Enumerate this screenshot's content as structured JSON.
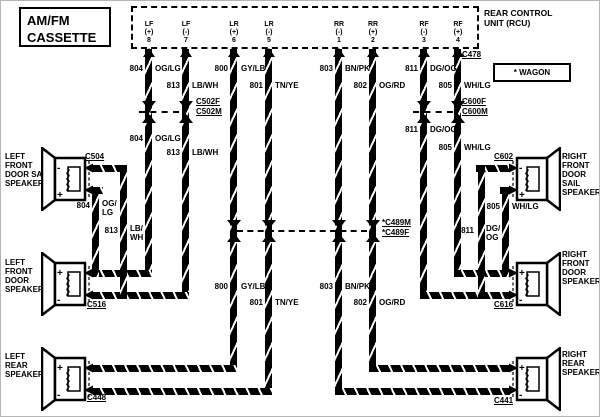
{
  "title": {
    "line1": "AM/FM",
    "line2": "CASSETTE"
  },
  "rcu": {
    "name_line1": "REAR CONTROL",
    "name_line2": "UNIT (RCU)",
    "pins": [
      {
        "ch": "LF",
        "pol": "(+)",
        "num": "8"
      },
      {
        "ch": "LF",
        "pol": "(-)",
        "num": "7"
      },
      {
        "ch": "LR",
        "pol": "(+)",
        "num": "6"
      },
      {
        "ch": "LR",
        "pol": "(-)",
        "num": "5"
      },
      {
        "ch": "RR",
        "pol": "(-)",
        "num": "1"
      },
      {
        "ch": "RR",
        "pol": "(+)",
        "num": "2"
      },
      {
        "ch": "RF",
        "pol": "(-)",
        "num": "3"
      },
      {
        "ch": "RF",
        "pol": "(+)",
        "num": "4"
      }
    ]
  },
  "note": "* WAGON",
  "circuits": {
    "c804": {
      "num": "804",
      "color": "OG/LG",
      "l1": "OG/",
      "l2": "LG"
    },
    "c813": {
      "num": "813",
      "color": "LB/WH",
      "l1": "LB/",
      "l2": "WH"
    },
    "c800": {
      "num": "800",
      "color": "GY/LB"
    },
    "c801": {
      "num": "801",
      "color": "TN/YE"
    },
    "c803": {
      "num": "803",
      "color": "BN/PK"
    },
    "c802": {
      "num": "802",
      "color": "OG/RD"
    },
    "c811": {
      "num": "811",
      "color": "DG/OG",
      "l1": "DG/",
      "l2": "OG"
    },
    "c805": {
      "num": "805",
      "color": "WH/LG"
    }
  },
  "connectors": {
    "c478": "C478",
    "c502f": "C502F",
    "c502m": "C502M",
    "c600f": "C600F",
    "c600m": "C600M",
    "c489m": "*C489M",
    "c489f": "*C489F",
    "c504": "C504",
    "c516": "C516",
    "c448": "C448",
    "c602": "C602",
    "c616": "C616",
    "c441": "C441"
  },
  "speakers": {
    "left_sail": {
      "l1": "LEFT",
      "l2": "FRONT",
      "l3": "DOOR SAIL",
      "l4": "SPEAKER",
      "top_mark": "-",
      "bottom_mark": "+"
    },
    "left_door": {
      "l1": "LEFT",
      "l2": "FRONT",
      "l3": "DOOR",
      "l4": "SPEAKER",
      "top_mark": "+",
      "bottom_mark": "-"
    },
    "left_rear": {
      "l1": "LEFT",
      "l2": "REAR",
      "l3": "SPEAKER",
      "l4": "",
      "top_mark": "+",
      "bottom_mark": "-"
    },
    "right_sail": {
      "l1": "RIGHT",
      "l2": "FRONT",
      "l3": "DOOR SAIL",
      "l4": "SPEAKER",
      "top_mark": "-",
      "bottom_mark": "+"
    },
    "right_door": {
      "l1": "RIGHT",
      "l2": "FRONT",
      "l3": "DOOR",
      "l4": "SPEAKER",
      "top_mark": "+",
      "bottom_mark": "-"
    },
    "right_rear": {
      "l1": "RIGHT",
      "l2": "REAR",
      "l3": "SPEAKER",
      "l4": "",
      "top_mark": "+",
      "bottom_mark": "-"
    }
  }
}
